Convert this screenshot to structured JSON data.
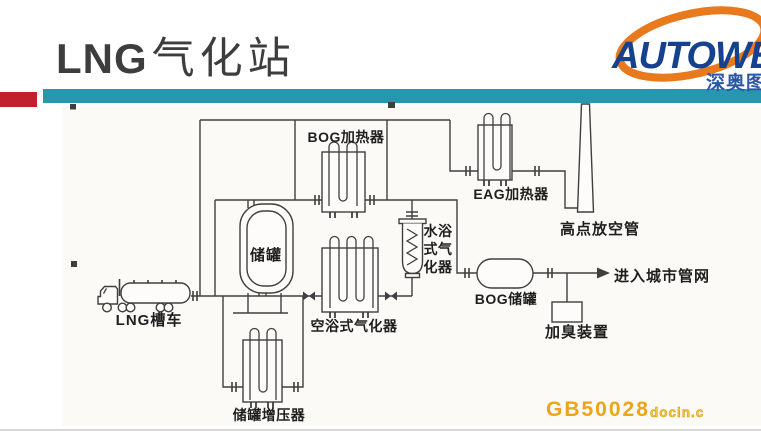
{
  "slide": {
    "title_latin": "LNG",
    "title_cjk": "气化站"
  },
  "colors": {
    "accent_red": "#c2202d",
    "accent_teal": "#2697ae",
    "logo_blue": "#15418e",
    "logo_orange": "#e8791d",
    "watermark_orange": "#eda31b",
    "diagram_line": "#3f3f3f"
  },
  "logo": {
    "brand": "AUTOWEN",
    "subtitle": "深奥图"
  },
  "diagram": {
    "labels": {
      "truck": "LNG槽车",
      "storage_tank": "储罐",
      "bog_heater": "BOG加热器",
      "air_bath_vaporizer": "空浴式气化器",
      "water_bath_vaporizer_line1": "水浴",
      "water_bath_vaporizer_line2": "式气",
      "water_bath_vaporizer_line3": "化器",
      "eag_heater": "EAG加热器",
      "vent_stack": "高点放空管",
      "bog_tank": "BOG储罐",
      "odorizer": "加臭装置",
      "city_network": "进入城市管网",
      "tank_pressurizer": "储罐增压器"
    },
    "watermark": {
      "code": "GB50028",
      "suffix": "docin.c"
    }
  }
}
